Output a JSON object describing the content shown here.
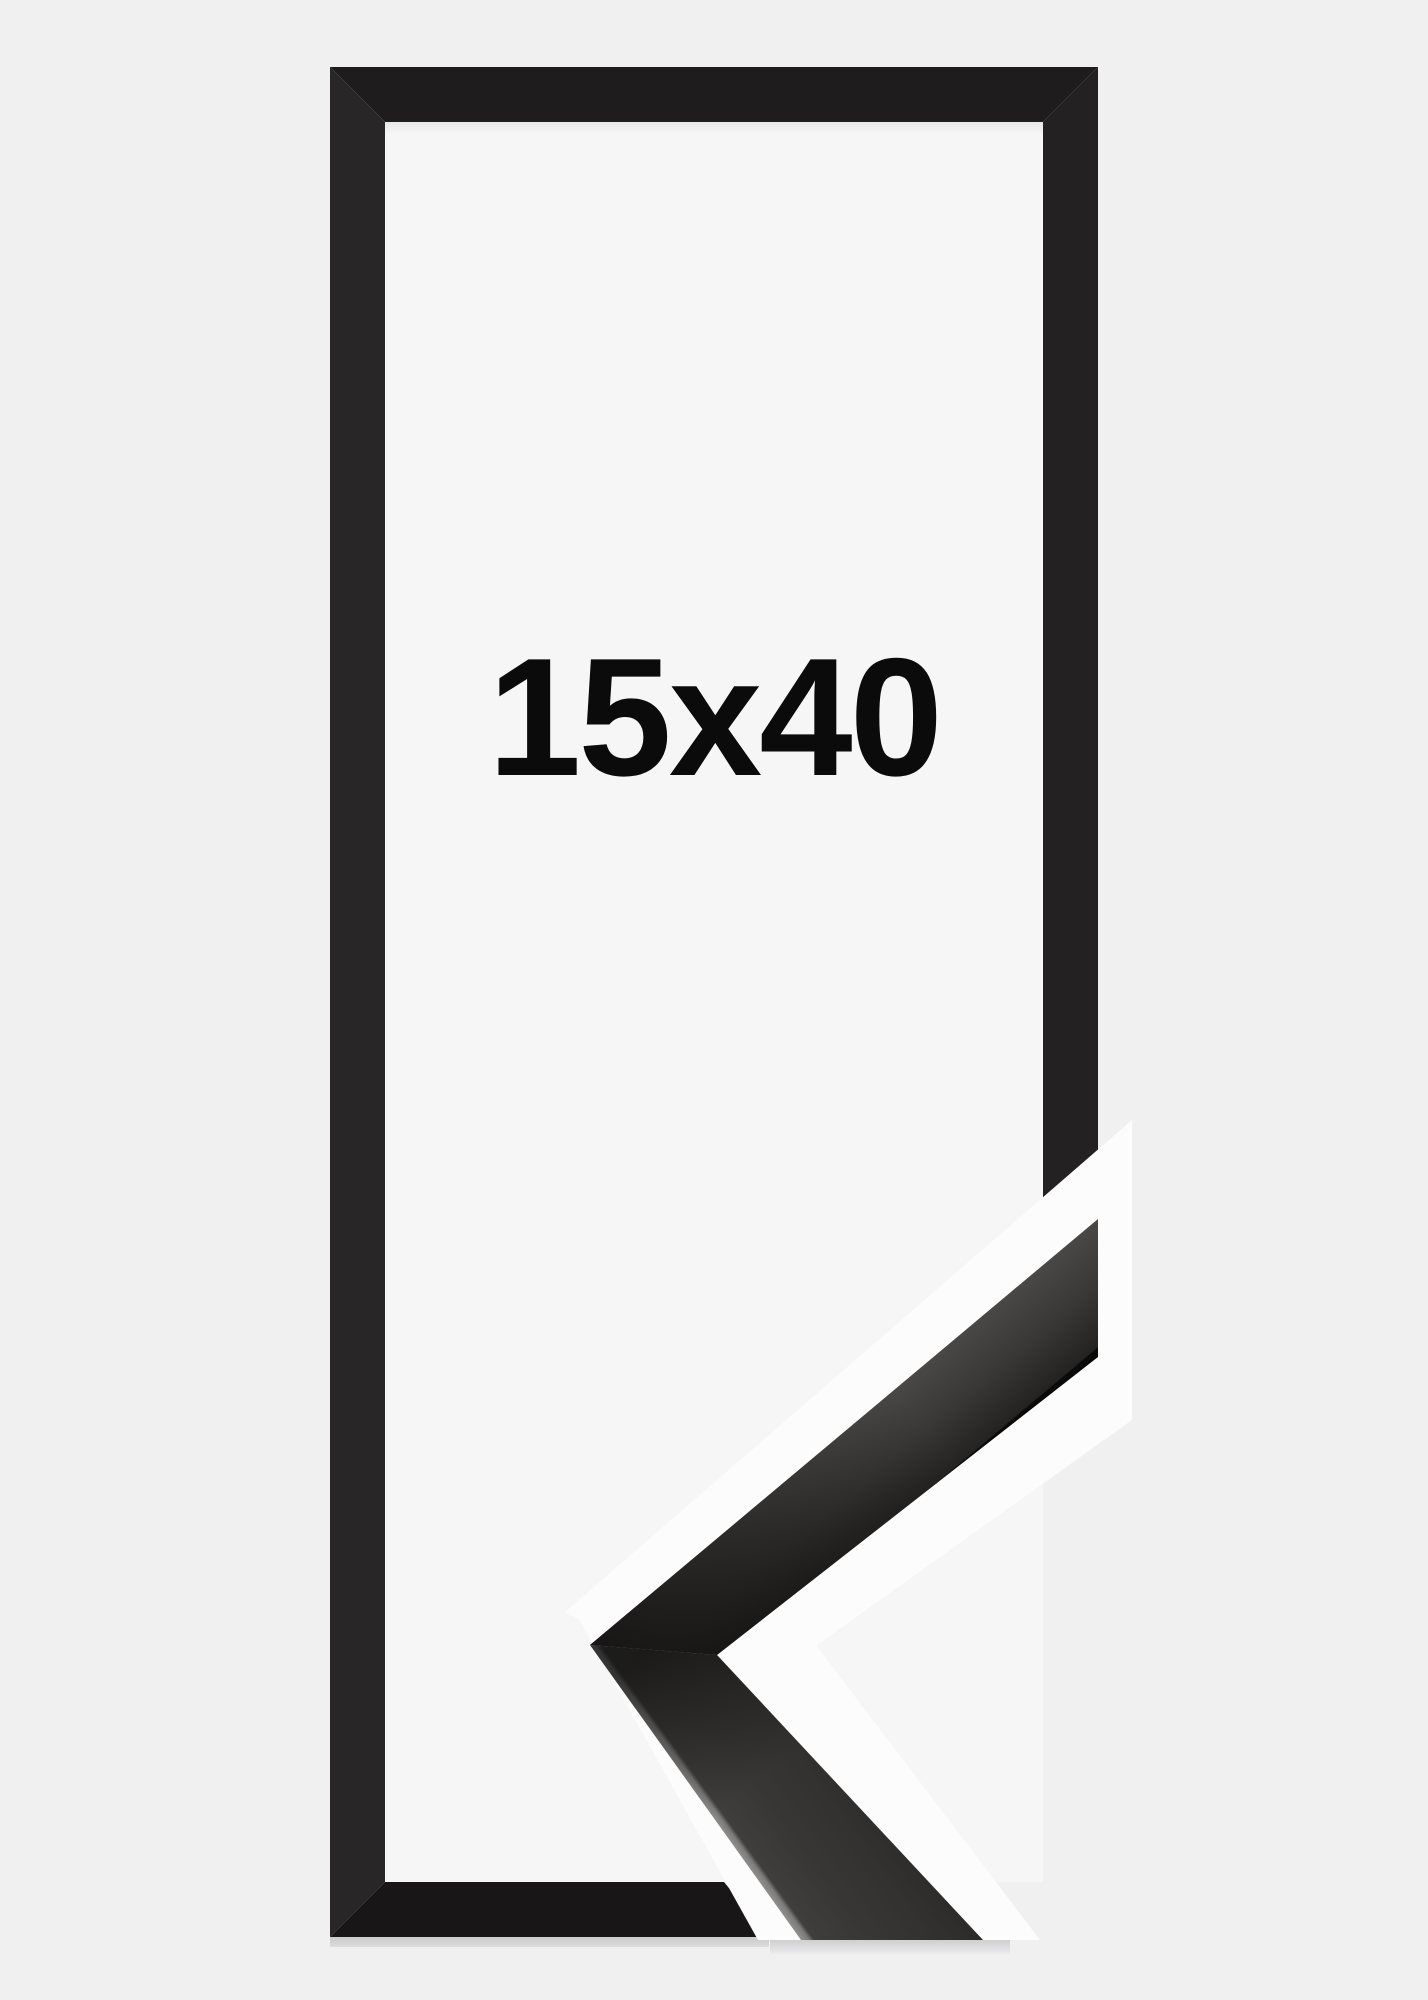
{
  "frame_product": {
    "size_label": "15x40",
    "colors": {
      "background": "#f0f0f1",
      "opening": "#f6f6f7",
      "halo": "#fcfcfd",
      "frame_top": "#1e1c1c",
      "frame_left": "#282626",
      "frame_right": "#232121",
      "frame_bottom": "#181616",
      "label_text": "#0b0b0b",
      "sample_face_dark": "#141313",
      "sample_face_graphite": "#3a3836",
      "sample_edge_light": "#8f8f8f"
    }
  }
}
